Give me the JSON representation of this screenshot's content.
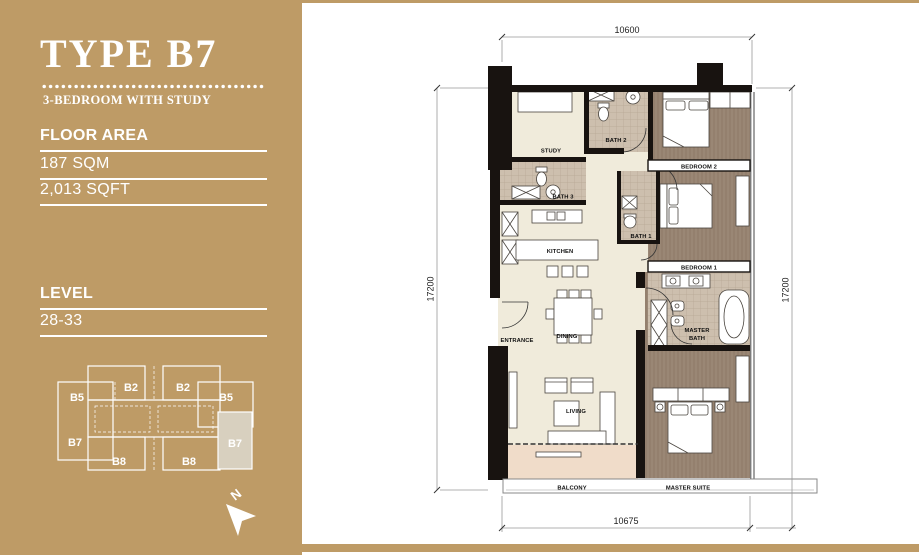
{
  "panel": {
    "title": "TYPE B7",
    "subtitle": "3-BEDROOM WITH STUDY",
    "floor_area_label": "FLOOR AREA",
    "floor_area_sqm": "187 SQM",
    "floor_area_sqft": "2,013 SQFT",
    "level_label": "LEVEL",
    "level_value": "28-33",
    "colors": {
      "background": "#BE9B66",
      "text": "#FFFFFF",
      "keyplan_highlight": "#D8D0BF"
    }
  },
  "key_plan": {
    "units": [
      {
        "label": "B5"
      },
      {
        "label": "B2"
      },
      {
        "label": "B2"
      },
      {
        "label": "B5"
      },
      {
        "label": "B7"
      },
      {
        "label": "B7"
      },
      {
        "label": "B8"
      },
      {
        "label": "B8"
      }
    ],
    "highlighted_unit": "B7",
    "north_label": "N"
  },
  "floor_plan": {
    "dimensions": {
      "top": "10600",
      "bottom": "10675",
      "left": "17200",
      "right": "17200"
    },
    "rooms": {
      "entrance": "ENTRANCE",
      "study": "STUDY",
      "bath2": "BATH 2",
      "bath3": "BATH 3",
      "kitchen": "KITCHEN",
      "dining": "DINING",
      "living": "LIVING",
      "balcony": "BALCONY",
      "bath1": "BATH 1",
      "bedroom1": "BEDROOM 1",
      "bedroom2": "BEDROOM 2",
      "master_bath_line1": "MASTER",
      "master_bath_line2": "BATH",
      "master_suite": "MASTER SUITE"
    }
  }
}
